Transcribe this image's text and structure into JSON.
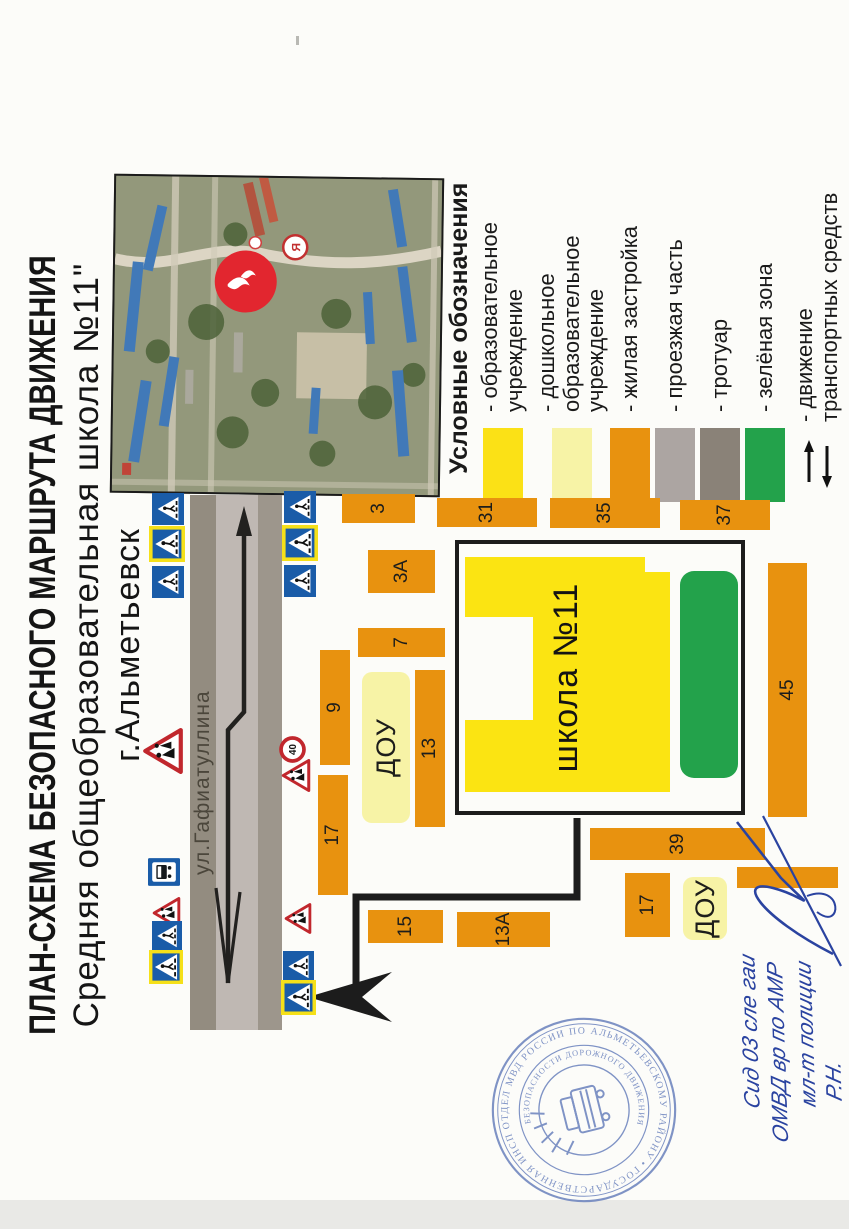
{
  "document": {
    "title_line1": "ПЛАН-СХЕМА БЕЗОПАСНОГО МАРШРУТА ДВИЖЕНИЯ",
    "title_line2": "Средняя общеобразовательная школа №11\"",
    "title_line3": "г.Альметьевск"
  },
  "satellite": {
    "description": "aerial-photo-of-school-district",
    "markers": [
      "school-location-marker",
      "secondary-map-marker"
    ]
  },
  "legend": {
    "heading": "Условные обозначения",
    "items": [
      {
        "name": "education",
        "icon": "yellow-swatch",
        "color": "#fbe116",
        "label": "- образовательное\nучреждение",
        "top": 33
      },
      {
        "name": "preschool",
        "icon": "pale-yellow-swatch",
        "color": "#f7f3a6",
        "label": "- дошкольное\nобразовательное\nучреждение",
        "top": 90
      },
      {
        "name": "housing",
        "icon": "orange-swatch",
        "color": "#e8920f",
        "label": "- жилая застройка",
        "top": 165
      },
      {
        "name": "roadway",
        "icon": "gray-swatch",
        "color": "#aca5a2",
        "label": "- проезжая часть",
        "top": 210
      },
      {
        "name": "sidewalk",
        "icon": "dark-gray-swatch",
        "color": "#8a8278",
        "label": "- тротуар",
        "top": 255
      },
      {
        "name": "green-zone",
        "icon": "green-swatch",
        "color": "#23a24b",
        "label": "- зелёная зона",
        "top": 300
      },
      {
        "name": "traffic",
        "icon": "two-way-arrows",
        "color": "",
        "label": "- движение\nтранспортных средств",
        "top": 348
      }
    ]
  },
  "map": {
    "street_name": "ул.Гафиатуллина",
    "school_label": "школа №11",
    "speed_limit_value": "40",
    "buildings": [
      {
        "label": "3",
        "x": 677,
        "y": 342,
        "w": 29,
        "h": 73
      },
      {
        "label": "3А",
        "x": 607,
        "y": 368,
        "w": 43,
        "h": 67
      },
      {
        "label": "31",
        "x": 673,
        "y": 437,
        "w": 29,
        "h": 100
      },
      {
        "label": "35",
        "x": 672,
        "y": 550,
        "w": 30,
        "h": 110
      },
      {
        "label": "37",
        "x": 670,
        "y": 680,
        "w": 30,
        "h": 90
      },
      {
        "label": "7",
        "x": 543,
        "y": 358,
        "w": 29,
        "h": 87
      },
      {
        "label": "9",
        "x": 435,
        "y": 320,
        "w": 115,
        "h": 30
      },
      {
        "label": "13",
        "x": 373,
        "y": 415,
        "w": 157,
        "h": 30
      },
      {
        "label": "17",
        "x": 305,
        "y": 318,
        "w": 120,
        "h": 30
      },
      {
        "label": "15",
        "x": 257,
        "y": 368,
        "w": 33,
        "h": 75
      },
      {
        "label": "13А",
        "x": 253,
        "y": 457,
        "w": 35,
        "h": 93
      },
      {
        "label": "39",
        "x": 340,
        "y": 590,
        "w": 32,
        "h": 175
      },
      {
        "label": "17",
        "x": 263,
        "y": 625,
        "w": 64,
        "h": 45
      },
      {
        "label": "45",
        "x": 383,
        "y": 768,
        "w": 254,
        "h": 39
      },
      {
        "label": "",
        "x": 312,
        "y": 737,
        "w": 21,
        "h": 101
      },
      {
        "label": "ДОУ",
        "x": 377,
        "y": 362,
        "w": 151,
        "h": 48,
        "kind": "dou"
      },
      {
        "label": "ДОУ",
        "x": 260,
        "y": 683,
        "w": 63,
        "h": 44,
        "kind": "dou"
      }
    ],
    "signs": [
      {
        "type": "ped",
        "x": 675,
        "y": 152,
        "s": 32
      },
      {
        "type": "ped_y",
        "x": 638,
        "y": 149,
        "s": 36
      },
      {
        "type": "ped",
        "x": 602,
        "y": 152,
        "s": 32
      },
      {
        "type": "warn",
        "x": 426,
        "y": 142,
        "s": 46
      },
      {
        "type": "bus",
        "x": 314,
        "y": 148,
        "s": 28
      },
      {
        "type": "warn",
        "x": 271,
        "y": 152,
        "s": 32
      },
      {
        "type": "ped",
        "x": 249,
        "y": 152,
        "s": 30
      },
      {
        "type": "ped_y",
        "x": 216,
        "y": 149,
        "s": 34
      },
      {
        "type": "ped",
        "x": 677,
        "y": 284,
        "s": 32
      },
      {
        "type": "ped_y",
        "x": 639,
        "y": 282,
        "s": 36
      },
      {
        "type": "ped",
        "x": 603,
        "y": 284,
        "s": 32
      },
      {
        "type": "warn",
        "x": 408,
        "y": 281,
        "s": 33
      },
      {
        "type": "s40",
        "x": 437,
        "y": 279,
        "s": 27
      },
      {
        "type": "warn",
        "x": 266,
        "y": 284,
        "s": 31
      },
      {
        "type": "ped",
        "x": 218,
        "y": 283,
        "s": 31
      },
      {
        "type": "ped_y",
        "x": 185,
        "y": 281,
        "s": 35
      }
    ]
  },
  "stamp": {
    "outer_ring_text": "ОТДЕЛ МВД РОССИИ ПО АЛЬМЕТЬЕВСКОМУ РАЙОНУ • ГОСУДАРСТВЕННАЯ ИНСПЕКЦИЯ • ",
    "inner_ring_text": "БЕЗОПАСНОСТИ ДОРОЖНОГО ДВИЖЕНИЯ",
    "emblem": "patrol-car-with-rays"
  },
  "handwriting": {
    "lines": [
      {
        "text": "Сид 03 сле гаи",
        "left": 62,
        "top": 4
      },
      {
        "text": "ОМВД вр по АМР",
        "left": 28,
        "top": 32
      },
      {
        "text": "мл-т полиции",
        "left": 64,
        "top": 60
      },
      {
        "text": "Р.Н.",
        "left": 70,
        "top": 88
      }
    ]
  },
  "colors": {
    "building_orange": "#e8920f",
    "school_yellow": "#fbe412",
    "preschool_yellow": "#f7f3a6",
    "green_zone": "#23a24b",
    "roadway_gray": "#bfb8b3",
    "sidewalk_gray": "#938c80",
    "sign_blue": "#1a5ca8",
    "sign_red": "#c1272d",
    "ink_blue": "#2a43a0",
    "stamp_blue": "#7288c0"
  }
}
